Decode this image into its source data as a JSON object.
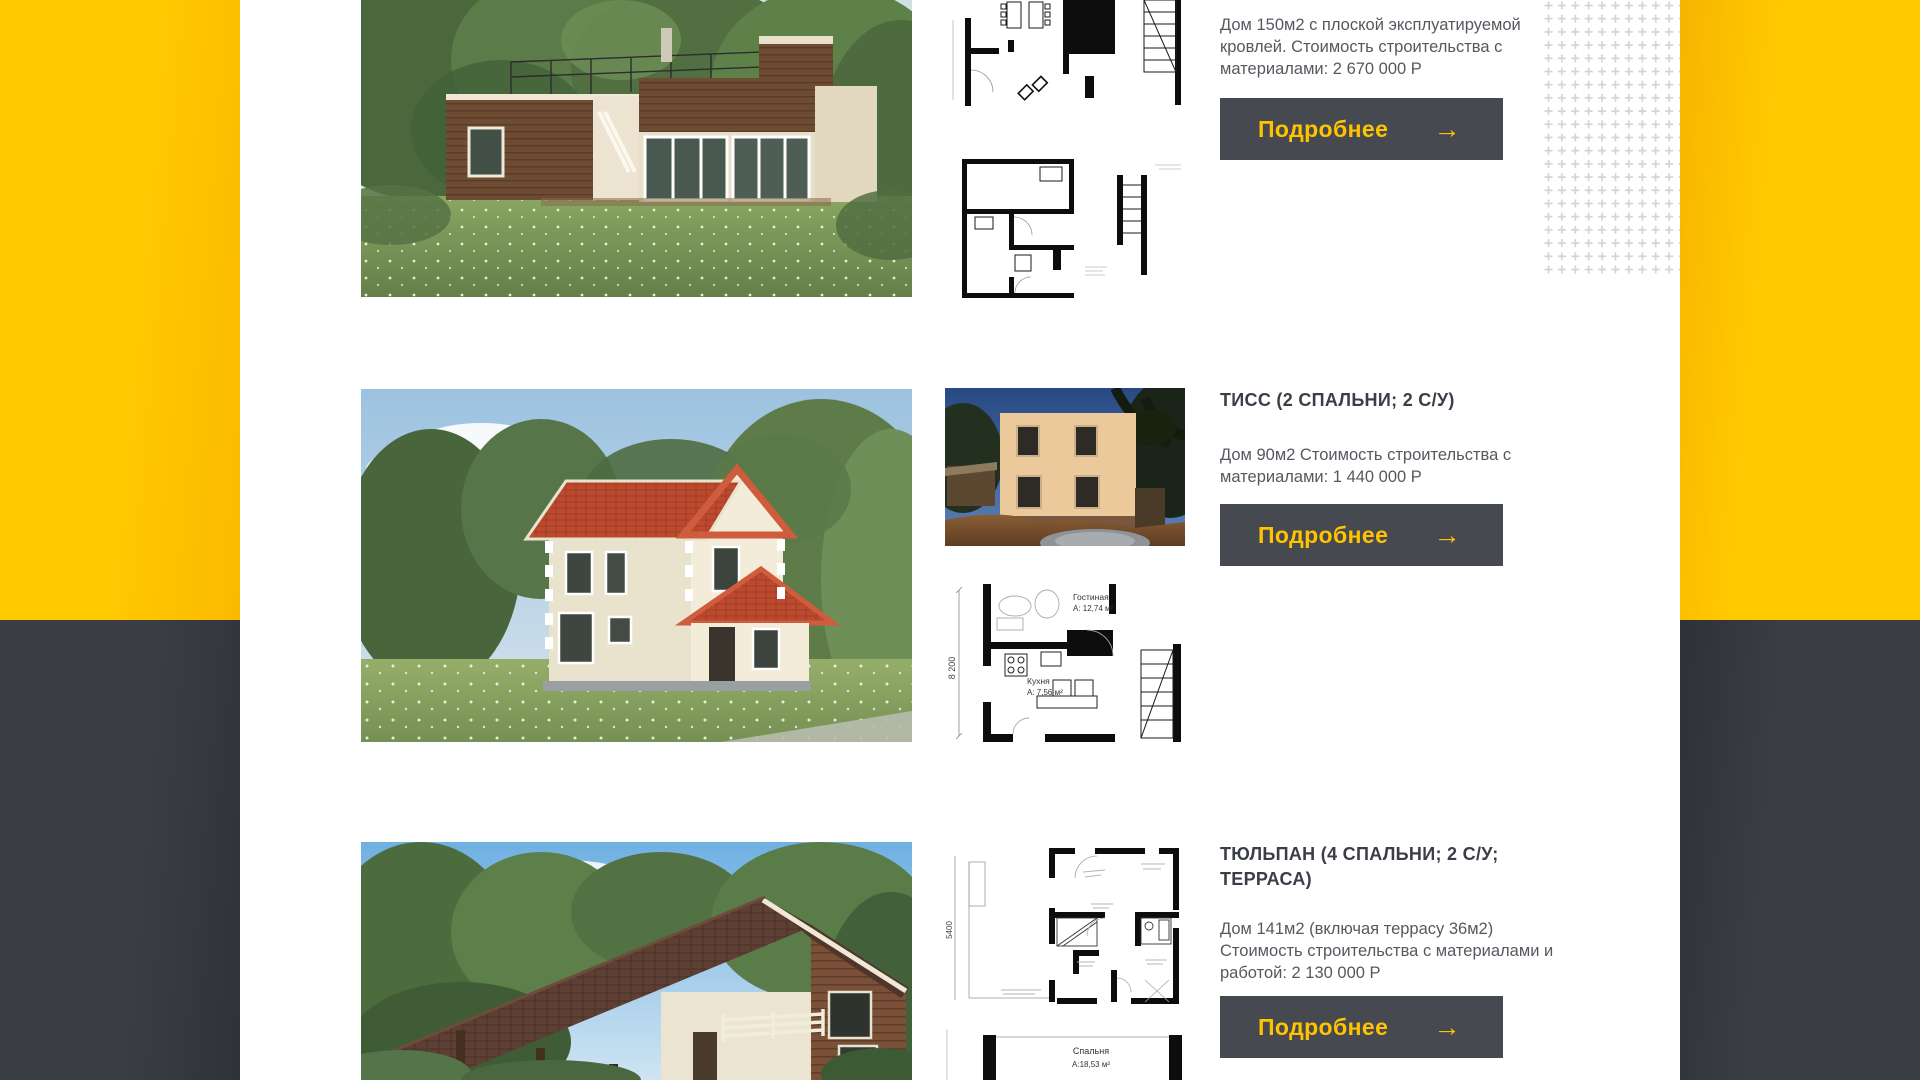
{
  "theme": {
    "accent_yellow": "#ffc400",
    "dark_panel": "#3b3e44",
    "button_bg": "#46494f",
    "button_text": "#ffc400",
    "title_color": "#3b3e48",
    "body_color": "#55585f",
    "pattern_plus_color": "#d4d4d6"
  },
  "cards": [
    {
      "description": "Дом 150м2 с плоской эксплуатируемой кровлей. Стоимость строительства с материалами: 2 670 000 Р",
      "button": {
        "label": "Подробнее",
        "arrow": "→"
      }
    },
    {
      "title": "ТИСС (2 СПАЛЬНИ; 2 С/У)",
      "description": "Дом 90м2 Стоимость строительства с материалами: 1 440 000 Р",
      "button": {
        "label": "Подробнее",
        "arrow": "→"
      },
      "plan": {
        "room1_name": "Гостиная",
        "room1_area": "А: 12,74 м²",
        "room2_name": "Кухня",
        "room2_area": "А: 7,56 м²",
        "dim_height": "8 200"
      }
    },
    {
      "title": "ТЮЛЬПАН (4 СПАЛЬНИ; 2 С/У; ТЕРРАСА)",
      "description": "Дом 141м2 (включая террасу 36м2) Стоимость строительства с материалами и работой: 2 130 000 Р",
      "button": {
        "label": "Подробнее",
        "arrow": "→"
      },
      "plan": {
        "dim_height": "5400"
      },
      "plan2": {
        "room_name": "Спальня",
        "room_area": "А:18,53 м²"
      }
    }
  ]
}
